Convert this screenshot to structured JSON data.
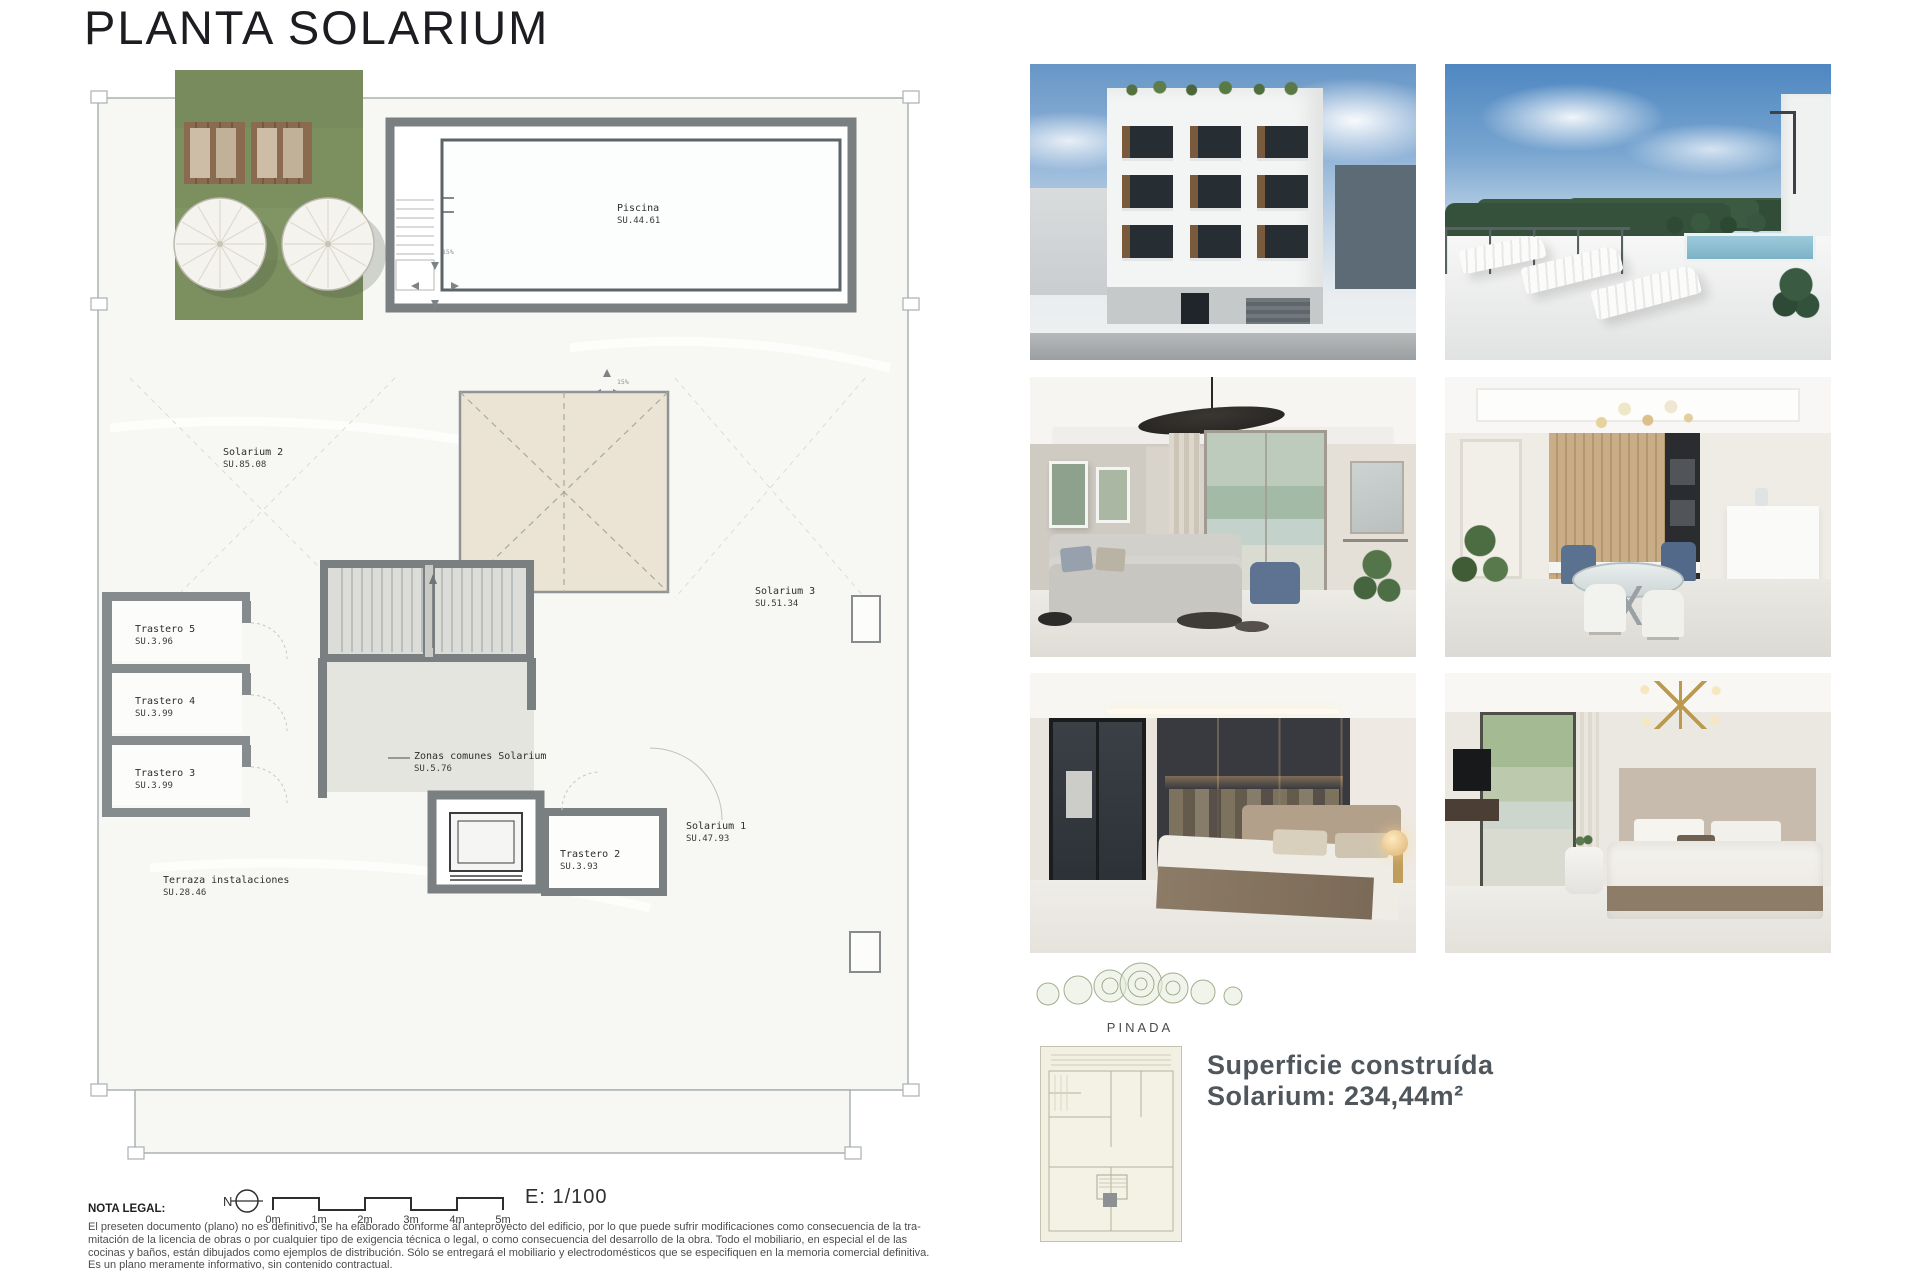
{
  "page": {
    "title": "PLANTA SOLARIUM",
    "scale_label": "E: 1/100",
    "north_label": "N"
  },
  "plan": {
    "rooms": [
      {
        "name": "Piscina",
        "su": "SU.44.61"
      },
      {
        "name": "Solarium 2",
        "su": "SU.85.08"
      },
      {
        "name": "Solarium 3",
        "su": "SU.51.34"
      },
      {
        "name": "Trastero 5",
        "su": "SU.3.96"
      },
      {
        "name": "Trastero 4",
        "su": "SU.3.99"
      },
      {
        "name": "Trastero 3",
        "su": "SU.3.99"
      },
      {
        "name": "Zonas comunes Solarium",
        "su": "SU.5.76"
      },
      {
        "name": "Trastero 2",
        "su": "SU.3.93"
      },
      {
        "name": "Solarium 1",
        "su": "SU.47.93"
      },
      {
        "name": "Terraza instalaciones",
        "su": "SU.28.46"
      }
    ],
    "slope_label": "15%",
    "scale_ticks": [
      "0m",
      "1m",
      "2m",
      "3m",
      "4m",
      "5m"
    ]
  },
  "legal": {
    "heading": "NOTA LEGAL:",
    "lines": [
      "El preseten documento (plano) no es definitivo, se ha elaborado conforme al anteproyecto del edificio, por lo que puede sufrir modificaciones como consecuencia de la tra-",
      "mitación de la licencia de obras o por cualquier tipo de exigencia técnica o legal, o como consecuencia del desarrollo de la obra. Todo el mobiliario, en especial el de las",
      "cocinas y baños, están dibujados como ejemplos de distribución. Sólo se entregará el mobiliario y electrodomésticos que se especifiquen en la memoria comercial definitiva.",
      "Es un plano meramente informativo, sin contenido contractual."
    ]
  },
  "site": {
    "label": "PINADA"
  },
  "summary": {
    "line1": "Superficie construída",
    "line2": "Solarium: 234,44m²"
  },
  "photos": [
    {
      "id": "building-exterior"
    },
    {
      "id": "rooftop-terrace"
    },
    {
      "id": "living-room"
    },
    {
      "id": "dining-kitchen"
    },
    {
      "id": "bedroom-wardrobe"
    },
    {
      "id": "bedroom-window"
    }
  ],
  "colors": {
    "grass_green": "#7b8f5f",
    "wall_gray": "#7a7f82",
    "skylight_beige": "#ebe4d4",
    "floor_light": "#f7f7f4",
    "summary_text": "#4f575d"
  }
}
